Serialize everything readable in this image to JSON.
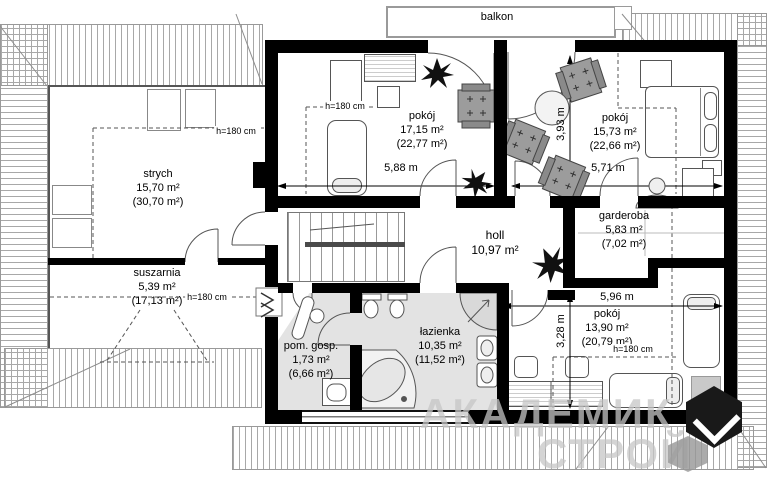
{
  "balcony": {
    "label": "balkon"
  },
  "rooms": {
    "strych": {
      "name": "strych",
      "area": "15,70 m²",
      "total": "(30,70 m²)"
    },
    "suszarnia": {
      "name": "suszarnia",
      "area": "5,39 m²",
      "total": "(17,13 m²)"
    },
    "pokoj1": {
      "name": "pokój",
      "area": "17,15 m²",
      "total": "(22,77 m²)"
    },
    "pokoj2": {
      "name": "pokój",
      "area": "15,73 m²",
      "total": "(22,66 m²)"
    },
    "garderoba": {
      "name": "garderoba",
      "area": "5,83 m²",
      "total": "(7,02 m²)"
    },
    "holl": {
      "name": "holl",
      "area": "10,97 m²",
      "total": ""
    },
    "lazienka": {
      "name": "łazienka",
      "area": "10,35 m²",
      "total": "(11,52 m²)"
    },
    "pom_gosp": {
      "name": "pom. gosp.",
      "area": "1,73 m²",
      "total": "(6,66 m²)"
    },
    "pokoj3": {
      "name": "pokój",
      "area": "13,90 m²",
      "total": "(20,79 m²)"
    }
  },
  "dimensions": {
    "room1_width": "5,88 m",
    "room2_width": "5,71 m",
    "room2_depth": "3,93 m",
    "room3_width": "5,96 m",
    "room3_depth": "3,28 m"
  },
  "height_label": "h=180 cm",
  "watermark": {
    "line1": "АКАДЕМИК",
    "line2": "СТРОЙ"
  },
  "icons": {
    "plant": "spiky-star-shape",
    "armchair": "gray-square-with-plus-marks",
    "door": "quarter-circle-arc",
    "stairs": "stepped-lines"
  },
  "colors": {
    "wall": "#000000",
    "bathroom_floor": "#e3e3e3",
    "furniture_gray": "#9c9c9c",
    "hatch_line": "#a8a8a8",
    "watermark_text": "#c6c6c6"
  }
}
